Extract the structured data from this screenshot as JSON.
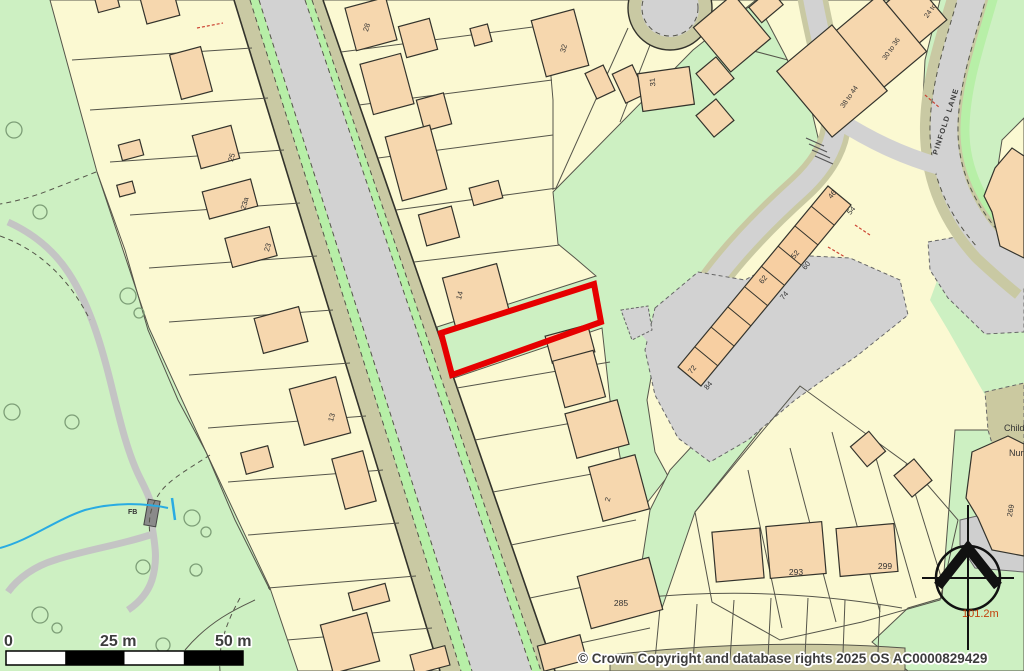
{
  "map": {
    "copyright": "© Crown Copyright and database rights 2025 OS AC0000829429",
    "scale_bar": {
      "start": "0",
      "mid": "25 m",
      "end": "50 m"
    },
    "spot_height": "101.2m",
    "street_name": "PINFOLD LANE",
    "nursery_line1": "Children's",
    "nursery_line2": "Nursery",
    "footbridge": "FB",
    "house_numbers": [
      {
        "text": "28"
      },
      {
        "text": "32"
      },
      {
        "text": "31"
      },
      {
        "text": "24 to"
      },
      {
        "text": "30 to 36"
      },
      {
        "text": "38 to 44"
      },
      {
        "text": "46"
      },
      {
        "text": "54"
      },
      {
        "text": "52"
      },
      {
        "text": "60"
      },
      {
        "text": "62"
      },
      {
        "text": "74"
      },
      {
        "text": "72"
      },
      {
        "text": "84"
      },
      {
        "text": "25"
      },
      {
        "text": "23a"
      },
      {
        "text": "23"
      },
      {
        "text": "13"
      },
      {
        "text": "14"
      },
      {
        "text": "2"
      },
      {
        "text": "285"
      },
      {
        "text": "293"
      },
      {
        "text": "299"
      },
      {
        "text": "269"
      }
    ],
    "colors": {
      "highlight": "#e60000",
      "parcel": "#fbf9d2",
      "building": "#f6d7ae",
      "road": "#d2d2d2",
      "verge": "#c9c9a3",
      "green": "#cdf0c2",
      "green_strip": "#b7efa7",
      "stream": "#29abe2",
      "spot_height_text": "#c2410c"
    }
  }
}
